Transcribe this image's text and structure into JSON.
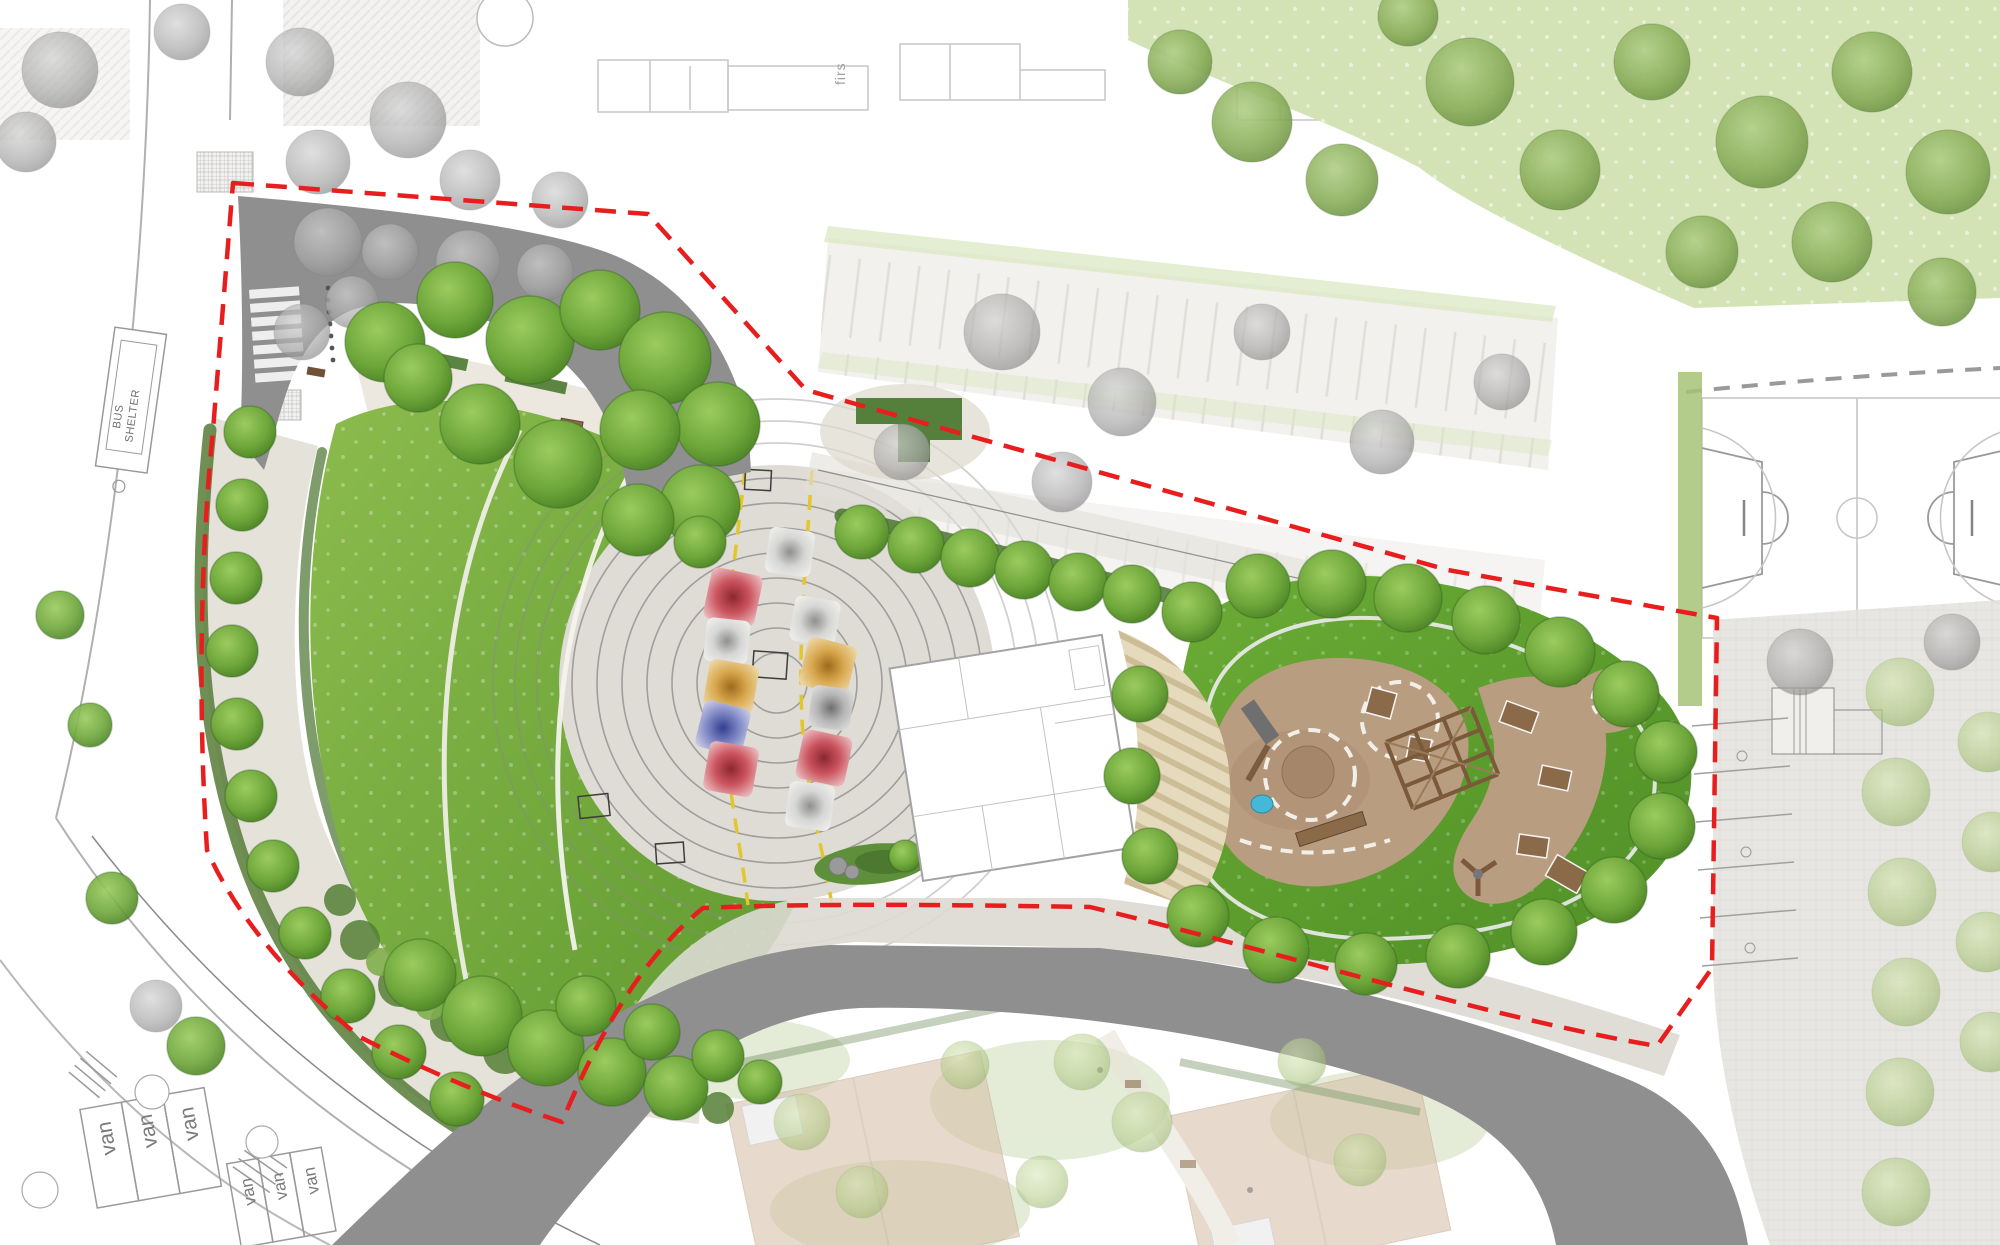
{
  "labels": {
    "bus_shelter_line1": "BUS",
    "bus_shelter_line2": "SHELTER",
    "floor_plan_note": "firs"
  },
  "parking": {
    "van_labels": [
      "van",
      "van",
      "van",
      "van",
      "van",
      "van"
    ]
  },
  "palette": {
    "boundary_red": "#e81e1e",
    "road_grey": "#8f8f8f",
    "paving_light": "#e5e2da",
    "plaza_paving": "#dfdcd5",
    "ring_grey": "#8a8a8a",
    "lawn_light": "#8cbb4d",
    "lawn_dark": "#5f9a30",
    "playground_lawn_light": "#6bab35",
    "playground_lawn_dark": "#4f8f26",
    "shrub_dark": "#4c7a33",
    "meadow_green": "#d3e3b6",
    "sand_tan": "#b99d80",
    "deck_tan": "#e6dabc",
    "deck_stripe": "#cdbd96",
    "timber_brown": "#8a6a48",
    "water_blue": "#45b8d8",
    "context_roof_tan": "#d8c2ab",
    "marking_yellow": "#e3c52c",
    "court_line": "#c2c2c2",
    "canopy_red": "#cc5560",
    "canopy_blue": "#7d85c4",
    "canopy_yellow": "#d8a94f",
    "canopy_white": "#d6d6d4",
    "canopy_grey": "#b5b5b5"
  },
  "plan": {
    "plaza": {
      "cx": 777,
      "cy": 683,
      "disc_r": 218,
      "rings": [
        30,
        55,
        80,
        105,
        130,
        155,
        180,
        205
      ],
      "outer_arcs": [
        240,
        262,
        284
      ]
    },
    "canopies": [
      {
        "x": 790,
        "y": 552,
        "s": 46,
        "rot": 8,
        "color": "white"
      },
      {
        "x": 733,
        "y": 597,
        "s": 52,
        "rot": 12,
        "color": "red"
      },
      {
        "x": 727,
        "y": 641,
        "s": 44,
        "rot": 6,
        "color": "white"
      },
      {
        "x": 815,
        "y": 621,
        "s": 46,
        "rot": 10,
        "color": "white"
      },
      {
        "x": 828,
        "y": 666,
        "s": 50,
        "rot": 14,
        "color": "yellow"
      },
      {
        "x": 731,
        "y": 687,
        "s": 50,
        "rot": 10,
        "color": "yellow"
      },
      {
        "x": 831,
        "y": 708,
        "s": 42,
        "rot": 8,
        "color": "grey"
      },
      {
        "x": 723,
        "y": 728,
        "s": 48,
        "rot": 14,
        "color": "blue"
      },
      {
        "x": 731,
        "y": 769,
        "s": 50,
        "rot": 10,
        "color": "red"
      },
      {
        "x": 824,
        "y": 758,
        "s": 50,
        "rot": 12,
        "color": "red"
      },
      {
        "x": 810,
        "y": 806,
        "s": 46,
        "rot": 8,
        "color": "white"
      }
    ],
    "trees": {
      "park_row": [
        [
          250,
          432,
          26
        ],
        [
          242,
          505,
          26
        ],
        [
          236,
          578,
          26
        ],
        [
          232,
          651,
          26
        ],
        [
          237,
          724,
          26
        ],
        [
          251,
          796,
          26
        ],
        [
          273,
          866,
          26
        ],
        [
          305,
          933,
          26
        ],
        [
          348,
          996,
          27
        ],
        [
          399,
          1052,
          27
        ],
        [
          457,
          1099,
          27
        ]
      ],
      "park_top": [
        [
          385,
          342,
          40
        ],
        [
          455,
          300,
          38
        ],
        [
          530,
          340,
          44
        ],
        [
          600,
          310,
          40
        ],
        [
          665,
          358,
          46
        ],
        [
          718,
          424,
          42
        ],
        [
          640,
          430,
          40
        ],
        [
          558,
          464,
          44
        ],
        [
          480,
          424,
          40
        ],
        [
          418,
          378,
          34
        ],
        [
          700,
          505,
          40
        ],
        [
          638,
          520,
          36
        ],
        [
          700,
          542,
          26
        ]
      ],
      "park_bottom": [
        [
          420,
          975,
          36
        ],
        [
          482,
          1016,
          40
        ],
        [
          546,
          1048,
          38
        ],
        [
          612,
          1072,
          34
        ],
        [
          676,
          1088,
          32
        ],
        [
          586,
          1006,
          30
        ],
        [
          652,
          1032,
          28
        ],
        [
          718,
          1056,
          26
        ],
        [
          760,
          1082,
          22
        ]
      ],
      "avenue": [
        [
          862,
          532,
          27
        ],
        [
          916,
          545,
          28
        ],
        [
          970,
          558,
          29
        ],
        [
          1024,
          570,
          29
        ],
        [
          1078,
          582,
          29
        ],
        [
          1132,
          594,
          29
        ]
      ],
      "playground_border": [
        [
          1192,
          612,
          30
        ],
        [
          1258,
          586,
          32
        ],
        [
          1332,
          584,
          34
        ],
        [
          1408,
          598,
          34
        ],
        [
          1486,
          620,
          34
        ],
        [
          1560,
          652,
          35
        ],
        [
          1626,
          694,
          33
        ],
        [
          1666,
          752,
          31
        ],
        [
          1662,
          826,
          33
        ],
        [
          1614,
          890,
          33
        ],
        [
          1544,
          932,
          33
        ],
        [
          1458,
          956,
          32
        ],
        [
          1366,
          964,
          31
        ],
        [
          1276,
          950,
          33
        ],
        [
          1198,
          916,
          31
        ],
        [
          1150,
          856,
          28
        ],
        [
          1132,
          776,
          28
        ],
        [
          1140,
          694,
          28
        ]
      ],
      "meadow": [
        [
          1180,
          62,
          32
        ],
        [
          1252,
          122,
          40
        ],
        [
          1342,
          180,
          36
        ],
        [
          1470,
          82,
          44
        ],
        [
          1560,
          170,
          40
        ],
        [
          1652,
          62,
          38
        ],
        [
          1762,
          142,
          46
        ],
        [
          1872,
          72,
          40
        ],
        [
          1948,
          172,
          42
        ],
        [
          1702,
          252,
          36
        ],
        [
          1832,
          242,
          40
        ],
        [
          1942,
          292,
          34
        ],
        [
          1408,
          16,
          30
        ]
      ],
      "context_grey": [
        [
          328,
          242,
          34
        ],
        [
          390,
          252,
          28
        ],
        [
          468,
          262,
          32
        ],
        [
          545,
          272,
          28
        ],
        [
          352,
          302,
          26
        ],
        [
          302,
          332,
          28
        ],
        [
          60,
          70,
          38
        ],
        [
          26,
          142,
          30
        ],
        [
          318,
          162,
          32
        ],
        [
          408,
          120,
          38
        ],
        [
          300,
          62,
          34
        ],
        [
          182,
          32,
          28
        ],
        [
          1002,
          332,
          38
        ],
        [
          1122,
          402,
          34
        ],
        [
          1262,
          332,
          28
        ],
        [
          902,
          452,
          28
        ],
        [
          1062,
          482,
          30
        ],
        [
          1382,
          442,
          32
        ],
        [
          1502,
          382,
          28
        ],
        [
          156,
          1006,
          26
        ],
        [
          1800,
          662,
          33
        ],
        [
          1952,
          642,
          28
        ],
        [
          470,
          180,
          30
        ],
        [
          560,
          200,
          28
        ]
      ],
      "left_green": [
        [
          112,
          898,
          26
        ],
        [
          196,
          1046,
          29
        ],
        [
          60,
          615,
          24
        ],
        [
          90,
          725,
          22
        ]
      ],
      "orchard_right": [
        [
          1900,
          692,
          34
        ],
        [
          1896,
          792,
          34
        ],
        [
          1902,
          892,
          34
        ],
        [
          1906,
          992,
          34
        ],
        [
          1900,
          1092,
          34
        ],
        [
          1896,
          1192,
          34
        ],
        [
          1988,
          742,
          30
        ],
        [
          1992,
          842,
          30
        ],
        [
          1986,
          942,
          30
        ],
        [
          1990,
          1042,
          30
        ]
      ],
      "garden_pale": [
        [
          802,
          1122,
          28
        ],
        [
          862,
          1192,
          26
        ],
        [
          1082,
          1062,
          28
        ],
        [
          1142,
          1122,
          30
        ],
        [
          1042,
          1182,
          26
        ],
        [
          1302,
          1062,
          24
        ],
        [
          1360,
          1160,
          26
        ],
        [
          965,
          1065,
          24
        ]
      ]
    }
  }
}
